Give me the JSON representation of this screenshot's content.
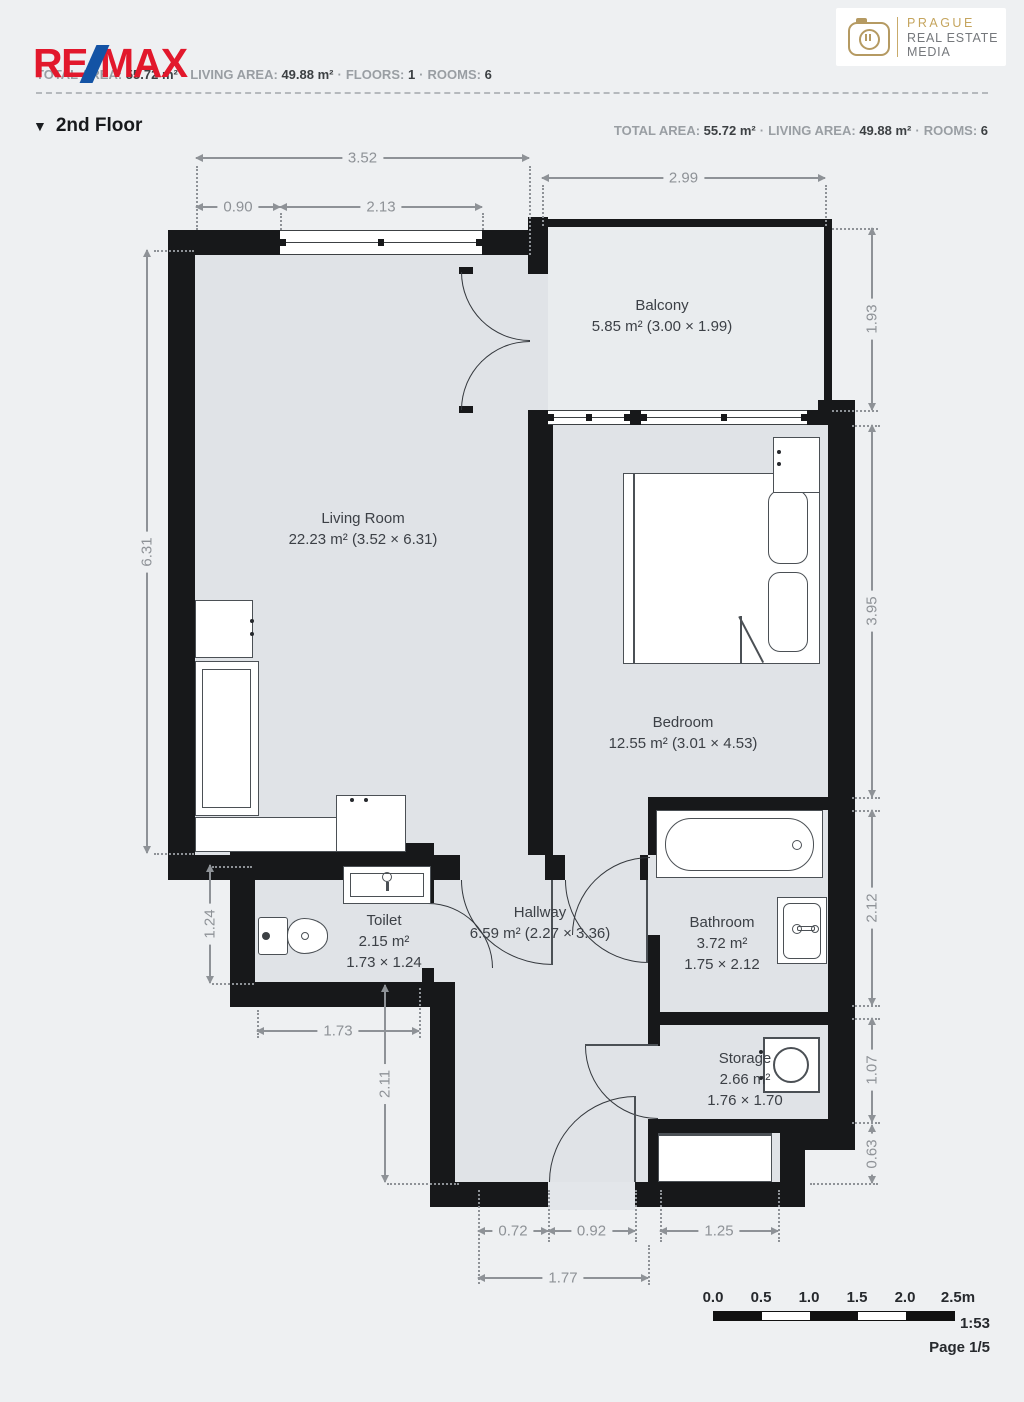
{
  "header": {
    "brand": {
      "part1": "RE",
      "part2": "MAX"
    },
    "stats": [
      {
        "label": "TOTAL AREA:",
        "value": "55.72 m²"
      },
      {
        "label": "LIVING AREA:",
        "value": "49.88 m²"
      },
      {
        "label": "FLOORS:",
        "value": "1"
      },
      {
        "label": "ROOMS:",
        "value": "6"
      }
    ],
    "stats2": [
      {
        "label": "TOTAL AREA:",
        "value": "55.72 m²"
      },
      {
        "label": "LIVING AREA:",
        "value": "49.88 m²"
      },
      {
        "label": "ROOMS:",
        "value": "6"
      }
    ],
    "separator": "·",
    "floor_marker": "▼",
    "floor_title": "2nd Floor",
    "media_logo": {
      "line1": "PRAGUE",
      "line2": "REAL ESTATE",
      "line3": "MEDIA"
    }
  },
  "plan": {
    "rooms": [
      {
        "id": "living",
        "lines": [
          "Living Room",
          "22.23 m² (3.52 × 6.31)"
        ]
      },
      {
        "id": "balcony",
        "lines": [
          "Balcony",
          "5.85 m² (3.00 × 1.99)"
        ]
      },
      {
        "id": "bedroom",
        "lines": [
          "Bedroom",
          "12.55 m² (3.01 × 4.53)"
        ]
      },
      {
        "id": "toilet",
        "lines": [
          "Toilet",
          "2.15 m²",
          "1.73 × 1.24"
        ]
      },
      {
        "id": "hallway",
        "lines": [
          "Hallway",
          "6.59 m² (2.27 × 3.36)"
        ]
      },
      {
        "id": "bathroom",
        "lines": [
          "Bathroom",
          "3.72 m²",
          "1.75 × 2.12"
        ]
      },
      {
        "id": "storage",
        "lines": [
          "Storage",
          "2.66 m²",
          "1.76 × 1.70"
        ]
      }
    ],
    "dimensions": [
      {
        "id": "w-total",
        "label": "3.52"
      },
      {
        "id": "w-left",
        "label": "0.90"
      },
      {
        "id": "w-window",
        "label": "2.13"
      },
      {
        "id": "balc-w",
        "label": "2.99"
      },
      {
        "id": "balc-h",
        "label": "1.93"
      },
      {
        "id": "lr-h",
        "label": "6.31"
      },
      {
        "id": "bed-h",
        "label": "3.95"
      },
      {
        "id": "bath-h",
        "label": "2.12"
      },
      {
        "id": "stor-h",
        "label": "1.07"
      },
      {
        "id": "niche-h",
        "label": "0.63"
      },
      {
        "id": "toilet-h",
        "label": "1.24"
      },
      {
        "id": "toilet-w",
        "label": "1.73"
      },
      {
        "id": "hall-h",
        "label": "2.11"
      },
      {
        "id": "ent-l",
        "label": "0.72"
      },
      {
        "id": "ent-door",
        "label": "0.92"
      },
      {
        "id": "niche-w",
        "label": "1.25"
      },
      {
        "id": "ent-total",
        "label": "1.77"
      }
    ],
    "colors": {
      "wall": "#17181a",
      "room_fill": "#e0e3e7",
      "balcony_fill": "#e9ecee",
      "page_bg": "#eef0f2",
      "dimension_text": "#8e9297",
      "label_text": "#3c4046",
      "brand_red": "#e2182c",
      "brand_blue": "#1353a5",
      "logo_gold": "#b59a62"
    }
  },
  "footer": {
    "scale_ticks": [
      "0.0",
      "0.5",
      "1.0",
      "1.5",
      "2.0",
      "2.5m"
    ],
    "scale_ratio": "1:53",
    "page": "Page 1/5"
  }
}
